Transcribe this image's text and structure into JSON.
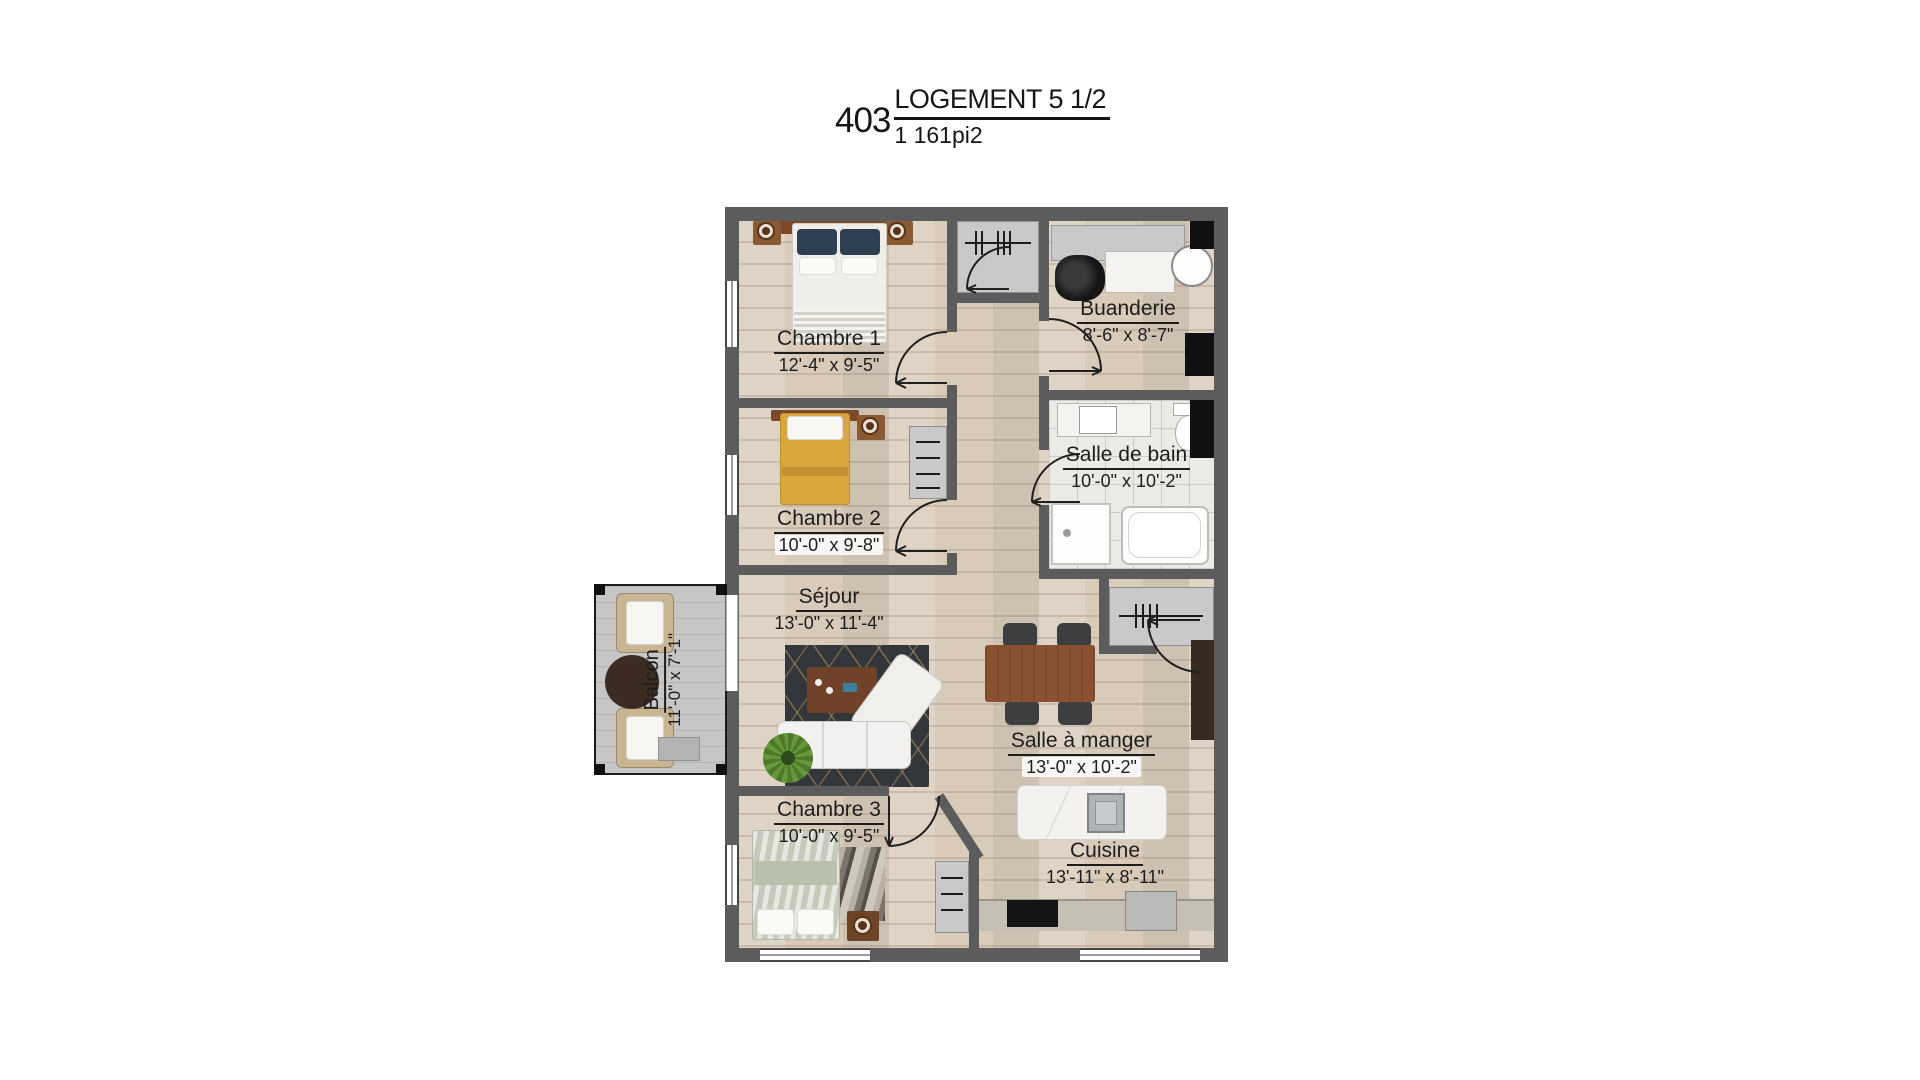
{
  "title": {
    "unit_number": "403",
    "label": "LOGEMENT 5 1/2",
    "area": "1 161pi2"
  },
  "rooms": {
    "chambre1": {
      "name": "Chambre 1",
      "dims": "12'-4\" x 9'-5\""
    },
    "chambre2": {
      "name": "Chambre 2",
      "dims": "10'-0\" x 9'-8\""
    },
    "chambre3": {
      "name": "Chambre 3",
      "dims": "10'-0\" x 9'-5\""
    },
    "buanderie": {
      "name": "Buanderie",
      "dims": "8'-6\" x 8'-7\""
    },
    "salle_de_bain": {
      "name": "Salle de bain",
      "dims": "10'-0\" x 10'-2\""
    },
    "sejour": {
      "name": "Séjour",
      "dims": "13'-0\" x 11'-4\""
    },
    "salle_a_manger": {
      "name": "Salle à manger",
      "dims": "13'-0\" x 10'-2\""
    },
    "cuisine": {
      "name": "Cuisine",
      "dims": "13'-11\" x 8'-11\""
    },
    "balcon": {
      "name": "Balcon",
      "dims": "11'-0\" x 7'-1\""
    }
  },
  "colors": {
    "wall": "#5c5c5c",
    "wood_floor": "#d8cbba",
    "balcony_deck": "#c6c6c6",
    "bed_accent_yellow": "#d9a73e",
    "dining_table_wood": "#8a5231",
    "rug_dark": "#33363b",
    "label_text": "#1d1d1d"
  }
}
